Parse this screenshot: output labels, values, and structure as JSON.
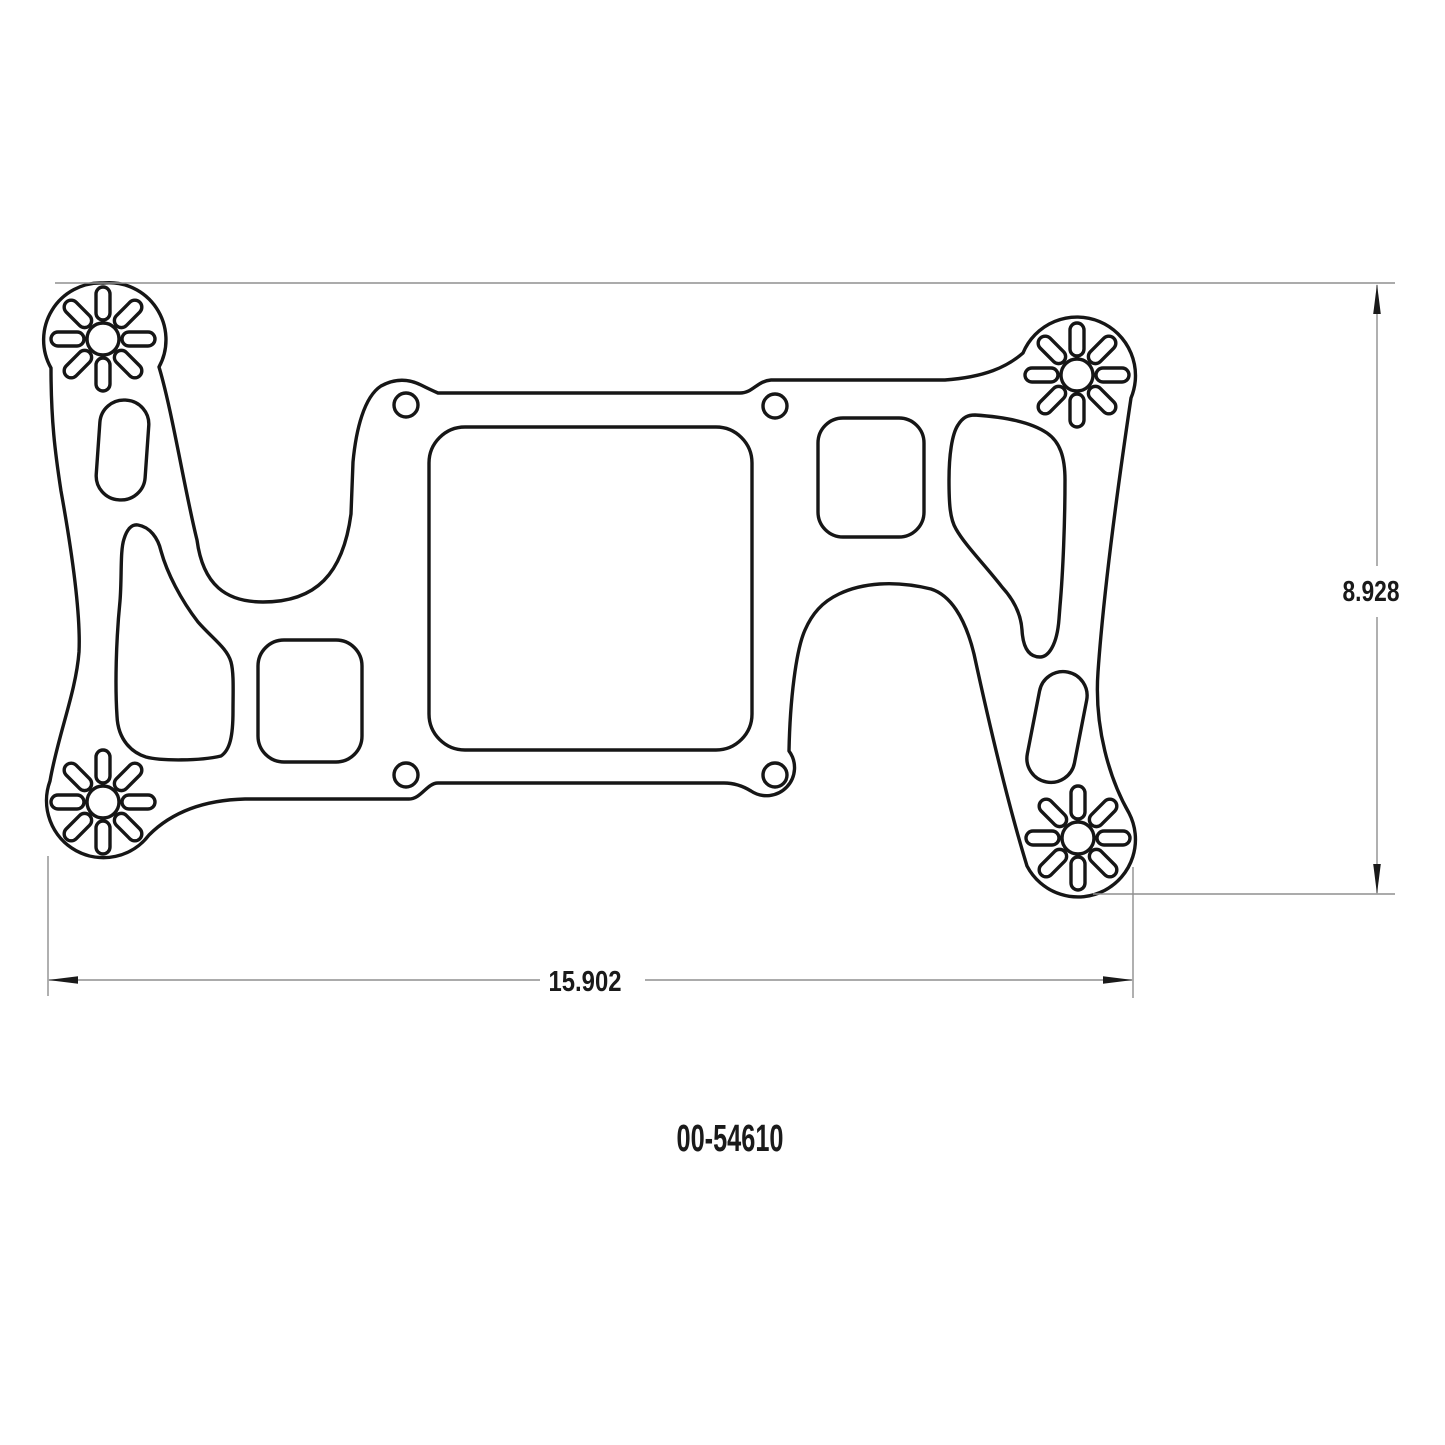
{
  "drawing": {
    "part_number": "00-54610",
    "width_dim": "15.902",
    "height_dim": "8.928"
  },
  "style": {
    "outline_color": "#161616",
    "dimension_color": "#8f8f8f",
    "text_color": "#1a1a1a",
    "background": "#ffffff"
  }
}
